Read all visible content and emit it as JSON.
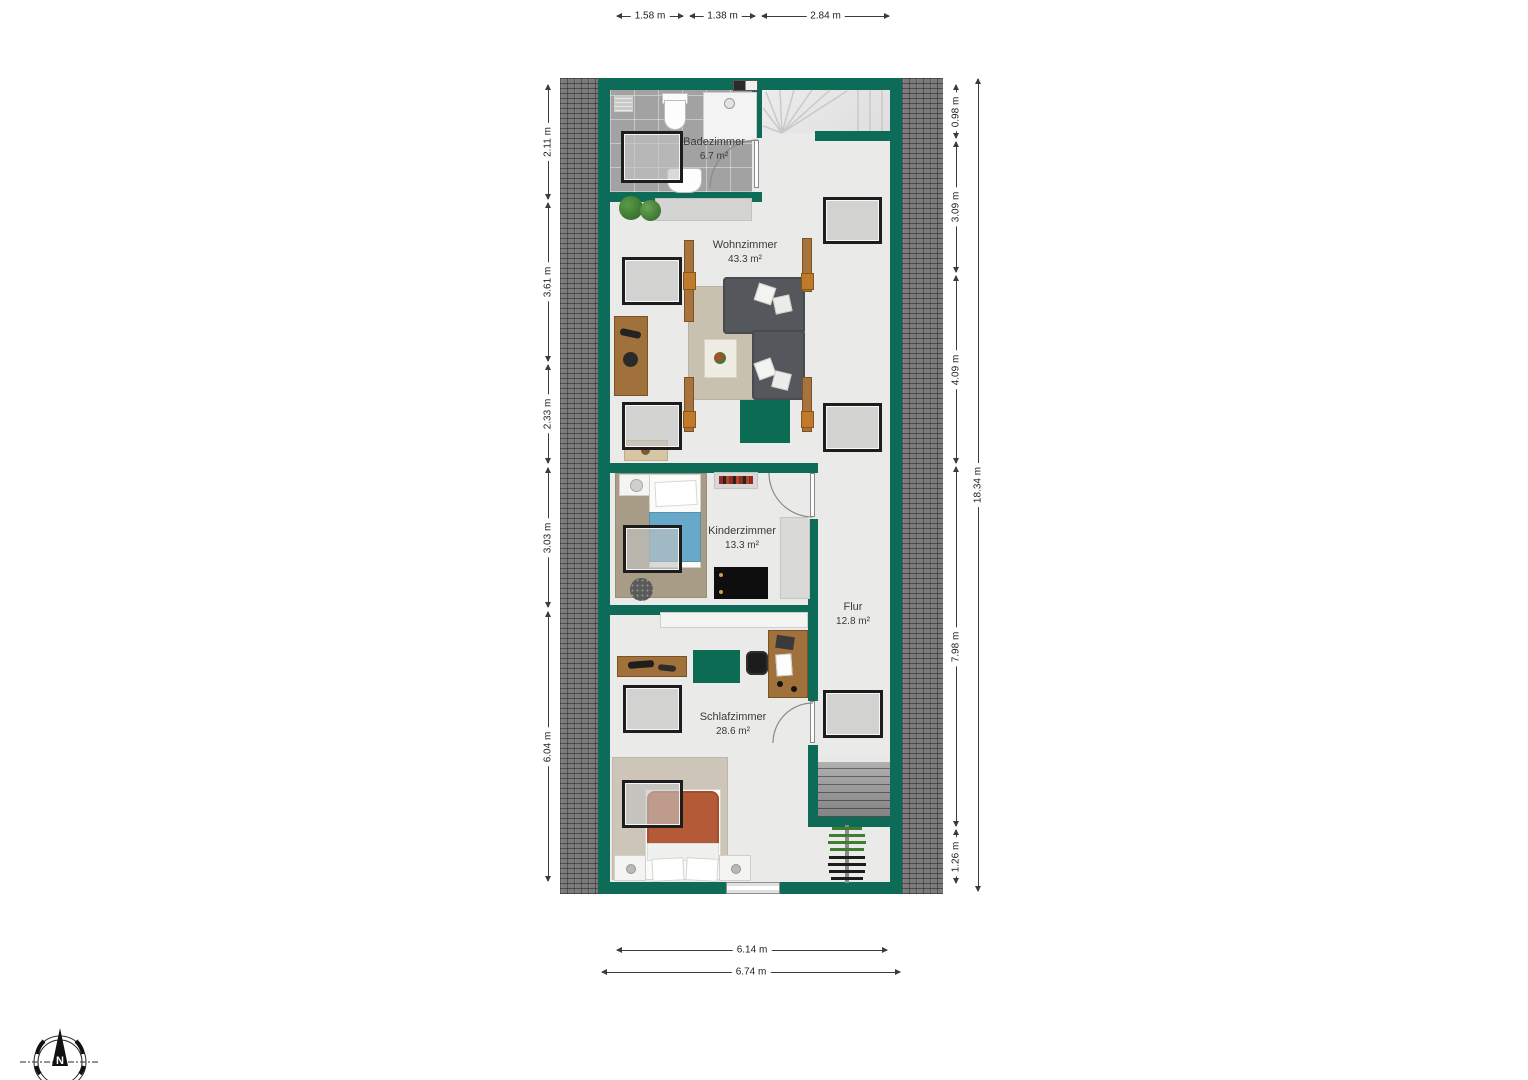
{
  "plan": {
    "rooms": [
      {
        "name": "Badezimmer",
        "area": "6.7 m²"
      },
      {
        "name": "Wohnzimmer",
        "area": "43.3 m²"
      },
      {
        "name": "Kinderzimmer",
        "area": "13.3 m²"
      },
      {
        "name": "Flur",
        "area": "12.8 m²"
      },
      {
        "name": "Schlafzimmer",
        "area": "28.6 m²"
      }
    ]
  },
  "dimensions": {
    "top": [
      {
        "label": "1.58 m"
      },
      {
        "label": "1.38 m"
      },
      {
        "label": "2.84 m"
      }
    ],
    "left": [
      {
        "label": "2.11 m"
      },
      {
        "label": "3.61 m"
      },
      {
        "label": "2.33 m"
      },
      {
        "label": "3.03 m"
      },
      {
        "label": "6.04 m"
      }
    ],
    "right": [
      {
        "label": "0.98 m"
      },
      {
        "label": "3.09 m"
      },
      {
        "label": "4.09 m"
      },
      {
        "label": "7.98 m"
      },
      {
        "label": "1.26 m"
      }
    ],
    "right_total": {
      "label": "18.34 m"
    },
    "bottom": [
      {
        "label": "6.14 m"
      },
      {
        "label": "6.74 m"
      }
    ]
  },
  "compass": {
    "north_label": "N"
  },
  "colors": {
    "wall_green": "#0e6b57",
    "roof_gray": "#7b7b7b",
    "floor": "#eaeae8",
    "accent_green_rug": "#0c6b53",
    "skylight_frame": "#1d1d1d"
  }
}
